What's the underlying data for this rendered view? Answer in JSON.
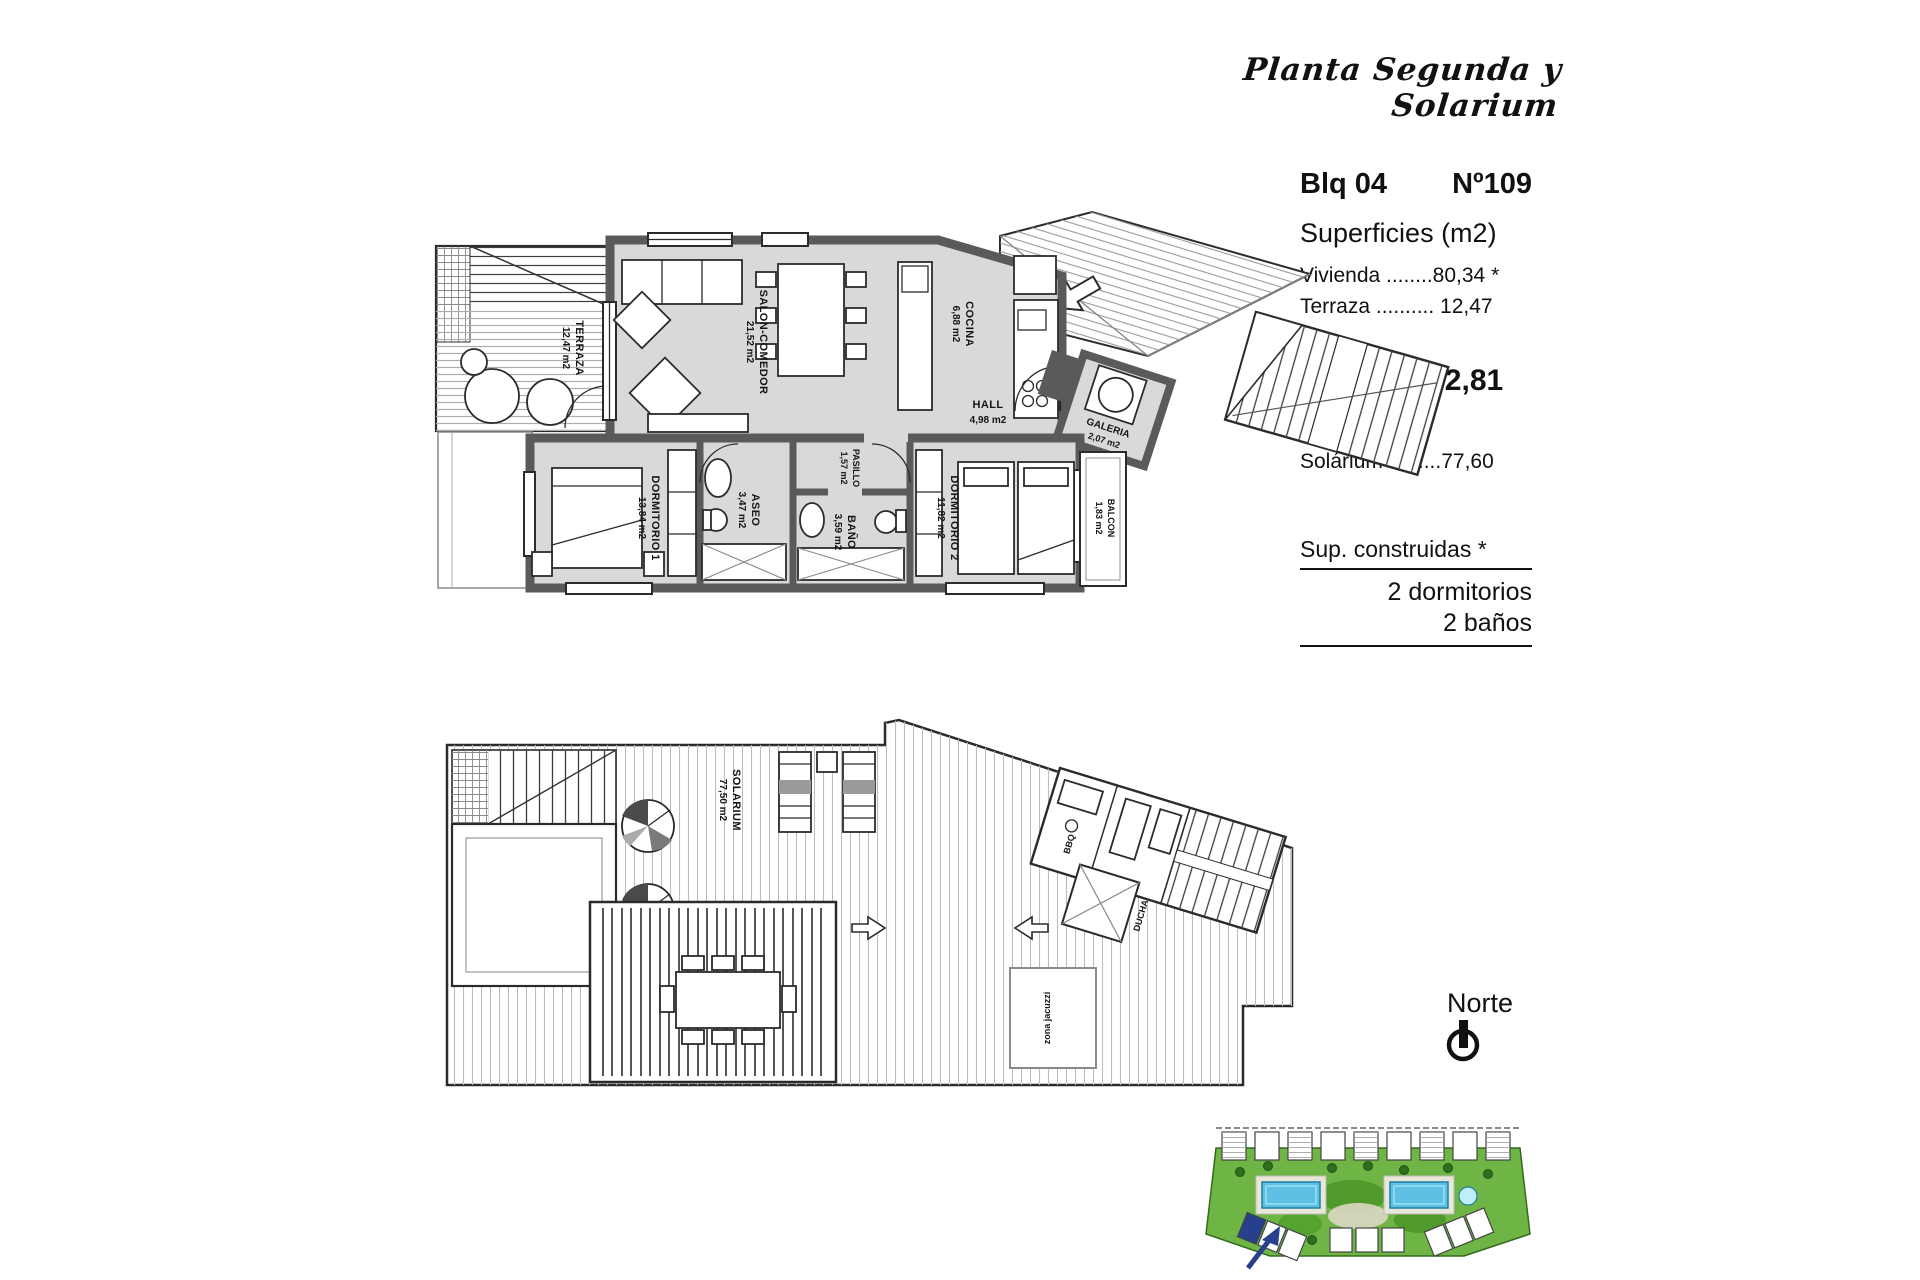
{
  "title": "Planta Segunda y Solarium",
  "info": {
    "block": "Blq 04",
    "unit": "Nº109",
    "superficies_heading": "Superficies (m2)",
    "vivienda_line": "Vivienda ........80,34 *",
    "terraza_line": "Terraza .......... 12,47",
    "total_label": "Total_",
    "total_value": "92,81",
    "solarium_line": "Solárium .........77,60",
    "sup_construidas": "Sup. construidas *",
    "dormitorios": "2 dormitorios",
    "banos": "2 baños"
  },
  "north_label": "Norte",
  "upper_plan": {
    "rooms": [
      {
        "name": "TERRAZA",
        "area": "12,47 m2"
      },
      {
        "name": "SALON-COMEDOR",
        "area": "21,52 m2"
      },
      {
        "name": "COCINA",
        "area": "6,88 m2"
      },
      {
        "name": "HALL",
        "area": "4,98 m2"
      },
      {
        "name": "GALERIA",
        "area": "2,07 m2"
      },
      {
        "name": "PASILLO",
        "area": "1,57 m2"
      },
      {
        "name": "DORMITORIO 1",
        "area": "13,84 m2"
      },
      {
        "name": "ASEO",
        "area": "3,47 m2"
      },
      {
        "name": "BAÑO",
        "area": "3,59 m2"
      },
      {
        "name": "DORMITORIO 2",
        "area": "11,82 m2"
      },
      {
        "name": "BALCON",
        "area": "1,83 m2"
      }
    ]
  },
  "lower_plan": {
    "rooms": [
      {
        "name": "SOLARIUM",
        "area": "77,50 m2"
      },
      {
        "name": "BBQ",
        "area": ""
      },
      {
        "name": "DUCHA",
        "area": ""
      },
      {
        "name": "zona jacuzzi",
        "area": ""
      }
    ]
  },
  "colors": {
    "wall": "#5a5a5a",
    "room_fill": "#d9d9d9",
    "pool": "#5ec1e4",
    "landscape": "#6fb545",
    "accent": "#27408b"
  }
}
